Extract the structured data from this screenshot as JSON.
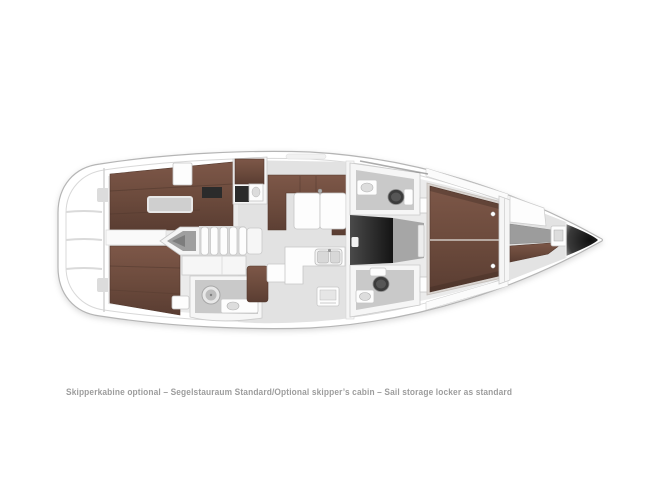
{
  "caption": {
    "text": "Skipperkabine optional – Segelstauraum Standard/Optional skipper’s cabin – Sail storage locker as standard"
  },
  "colors": {
    "caption-gray": "#9d9d9d",
    "hull-white": "#ffffff",
    "hull-stroke": "#b5b5b5",
    "interior-gray": "#ebebeb",
    "saloon-floor": "#e2e2e2",
    "wall-stroke": "#c9c9c9",
    "wood-light": "#7d5748",
    "wood-mid": "#6b4a3c",
    "wood-dark": "#5a3d32",
    "dark-locker": "#2b2b2b",
    "corridor-light": "#4a4a4a",
    "corridor-dark": "#141414",
    "shelf-gray": "#9c9c9c",
    "bow-dark": "#0f0f0f"
  }
}
